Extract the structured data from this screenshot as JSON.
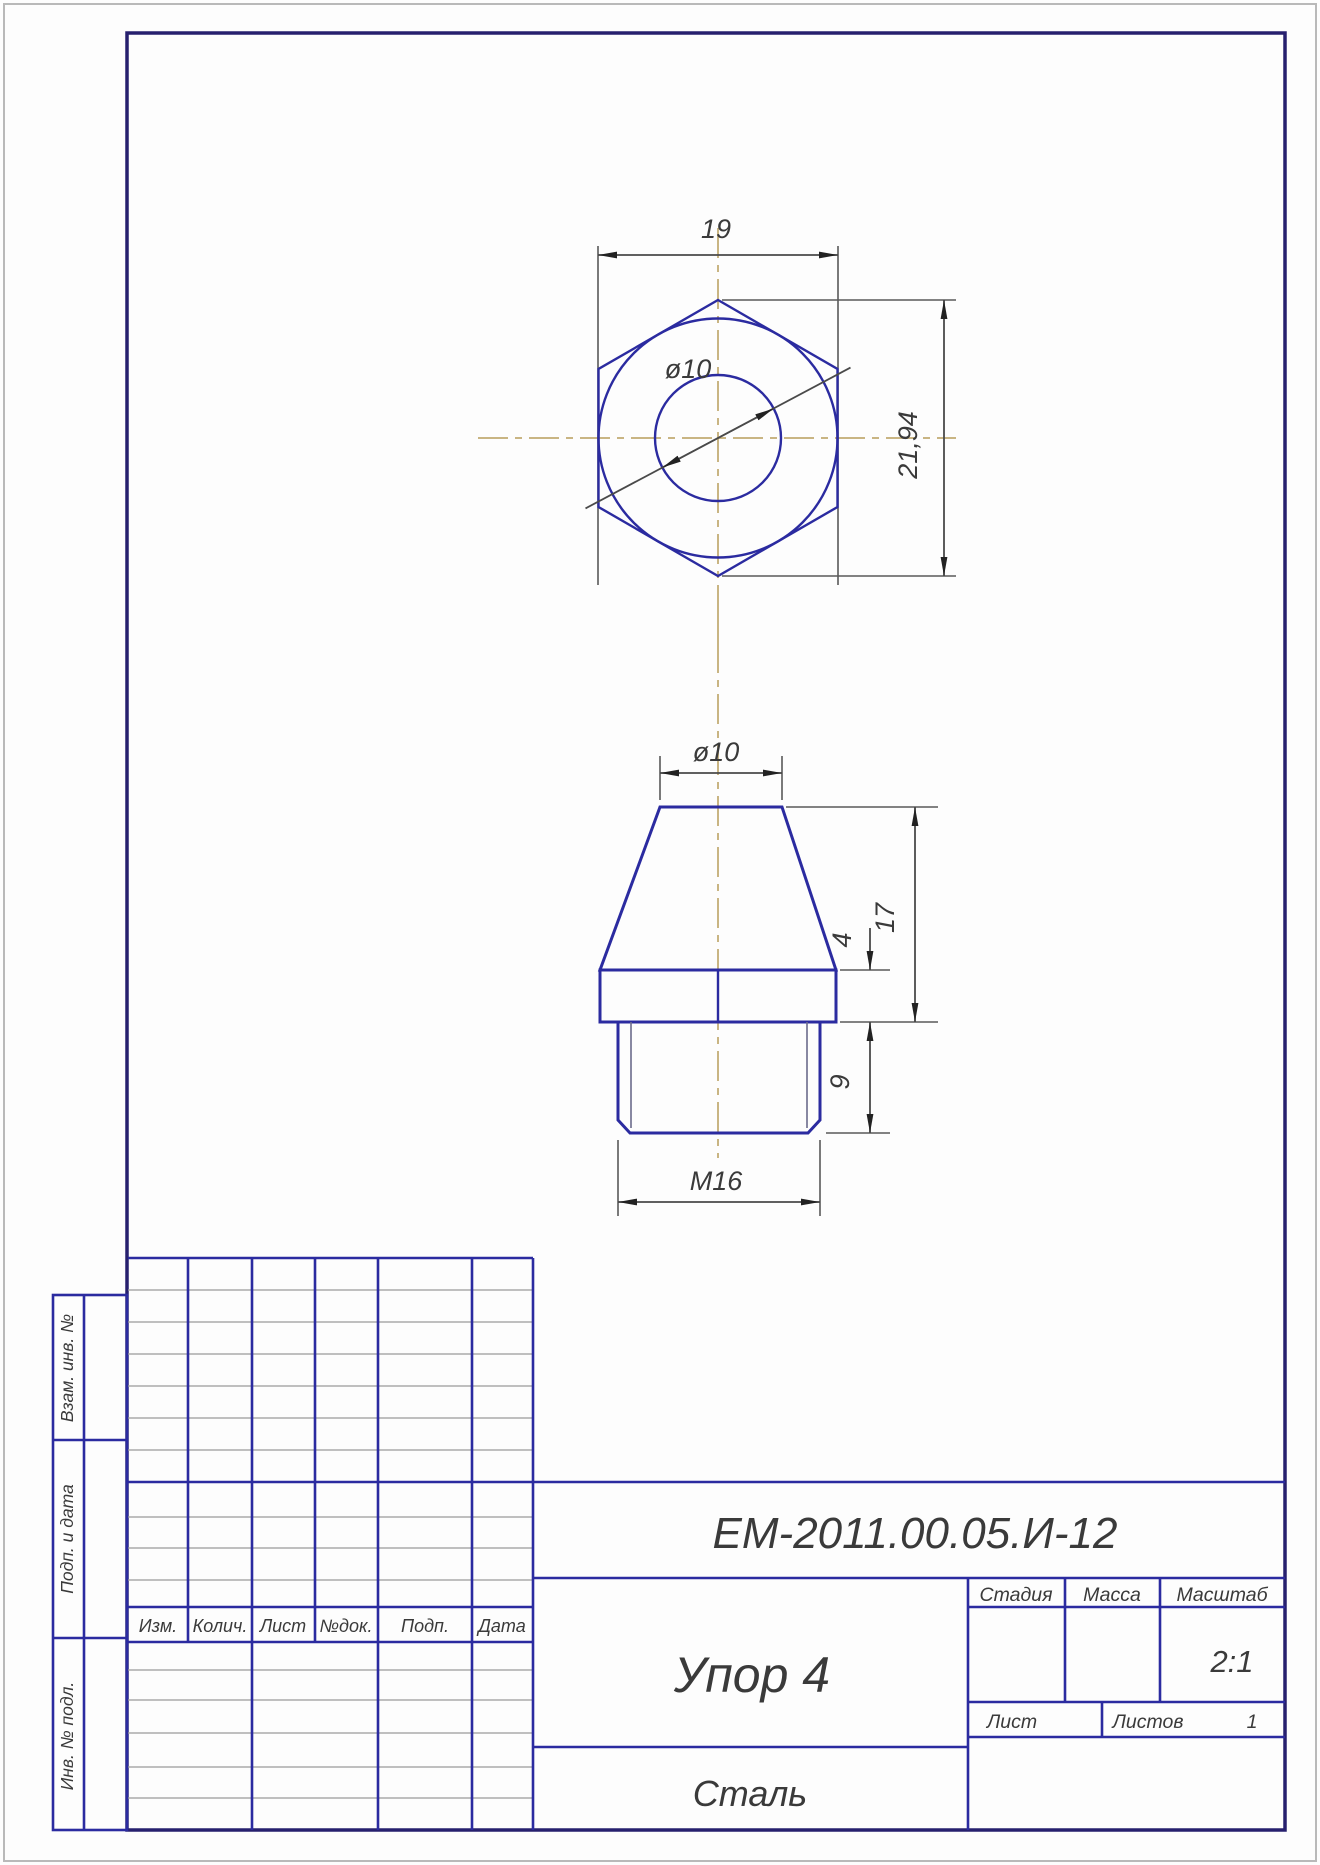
{
  "drawing": {
    "top_view": {
      "width_dim": "19",
      "corner_dim": "21,94",
      "hole_dim": "ø10"
    },
    "front_view": {
      "top_dim": "ø10",
      "cone_height_dim": "17",
      "flange_dim": "4",
      "thread_len_dim": "9",
      "thread_dim": "M16"
    }
  },
  "title_block": {
    "doc_number": "ЕМ-2011.00.05.И-12",
    "part_name": "Упор 4",
    "material": "Сталь",
    "stage_header": "Стадия",
    "mass_header": "Масса",
    "scale_header": "Масштаб",
    "scale_value": "2:1",
    "sheet_label": "Лист",
    "sheets_label": "Листов",
    "sheets_count": "1",
    "revision_headers": [
      "Изм.",
      "Колич.",
      "Лист",
      "№док.",
      "Подп.",
      "Дата"
    ]
  },
  "margin_stamps": {
    "reuse": "Взам. инв. №",
    "sign_date": "Подп. и дата",
    "inventory": "Инв. № подл."
  },
  "colors": {
    "part_line_blue": "#2b2ba0",
    "frame_blue": "#27206e",
    "dimension_gray": "#4a4a4a",
    "centerline_tan": "#c9b583",
    "page_border_gray": "#b9b9b9"
  }
}
